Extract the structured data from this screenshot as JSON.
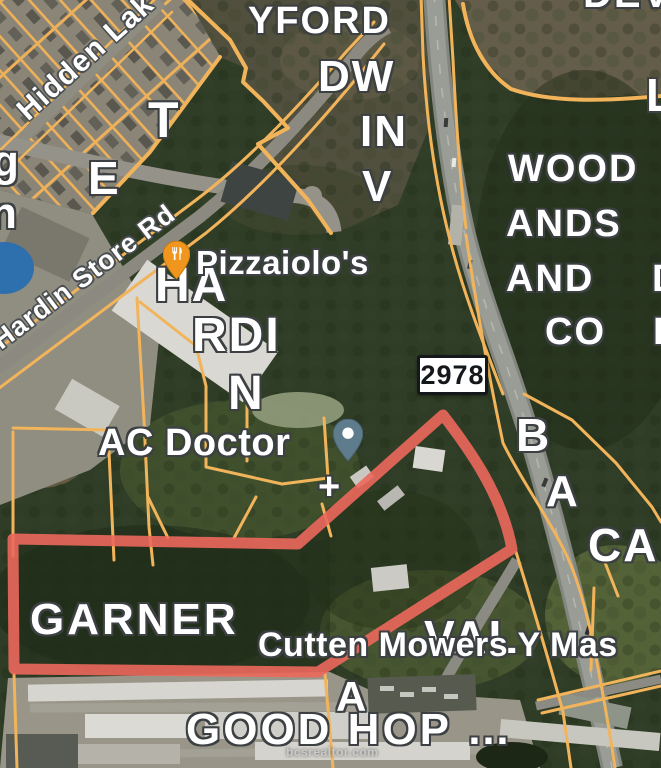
{
  "map": {
    "watermark": "bcsrealtor.com",
    "road_shield": {
      "route_number": "2978"
    },
    "road_labels": {
      "hidden_lake": "Hidden Lak",
      "hardin_store_rd": "Hardin Store Rd"
    },
    "poi": {
      "pizzaiolos": {
        "label": "Pizzaiolo's",
        "icon": "restaurant-pin",
        "pin_color": "#F0961E"
      },
      "ac_doctor": {
        "label": "AC Doctor",
        "icon": "place-pin",
        "pin_color": "#5E7C8C"
      },
      "cutten_mowers": {
        "label": "Cutten Mowers Y Mas"
      },
      "plus_marker": "+"
    },
    "area_labels": {
      "yford": "YFORD",
      "dw": "DW",
      "in": "IN",
      "v": "V",
      "t": "T",
      "e": "E",
      "g_partial": "g",
      "n_partial": "n",
      "dev_partial": "DEV",
      "l_partial": "L",
      "wood": "WOOD",
      "ands": "ANDS",
      "and": "AND",
      "d_partial_upper": "D",
      "co": "CO",
      "d_partial_lower": "D",
      "b": "B",
      "a_upper": "A",
      "ca": "CA",
      "ha": "HA",
      "rdi": "RDI",
      "n_hardin": "N",
      "garner": "GARNER",
      "val_partial": "VAL",
      "a_lower": "A",
      "good_hop": "GOOD HOP …"
    },
    "highlight_color": "#EC685C",
    "parcel_line_color": "#F2B45B"
  }
}
